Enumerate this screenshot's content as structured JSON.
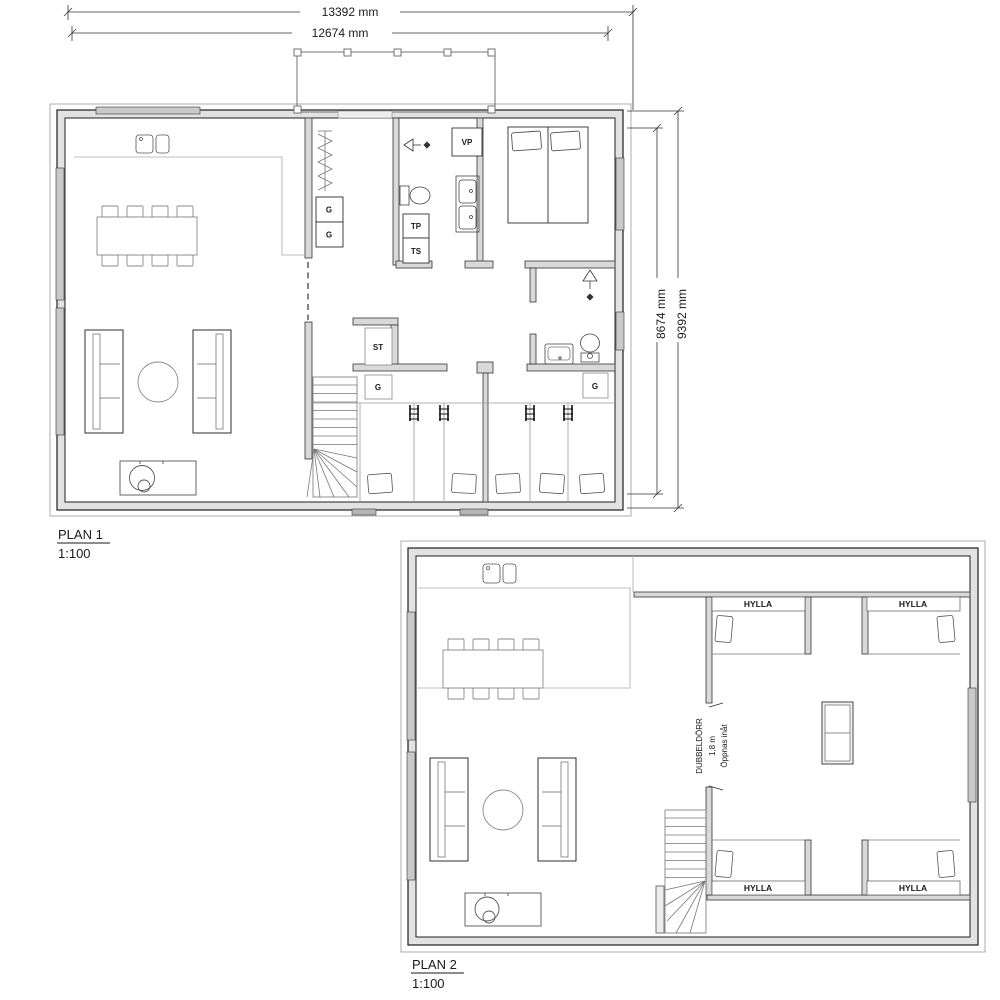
{
  "sheet": {
    "plan1": {
      "title": "PLAN 1",
      "scale": "1:100",
      "dims": {
        "top_outer": "13392 mm",
        "top_inner": "12674 mm",
        "right_inner": "8674 mm",
        "right_outer": "9392 mm"
      },
      "labels": {
        "wardrobe": "G",
        "cleaning_closet": "ST",
        "heat_pump": "VP",
        "laundry_top": "TP",
        "laundry_bottom": "TS"
      }
    },
    "plan2": {
      "title": "PLAN 2",
      "scale": "1:100",
      "labels": {
        "shelf": "HYLLA",
        "door_note_1": "DUBBELDÖRR",
        "door_note_2": "1,8 m",
        "door_note_3": "Öppnas inåt"
      }
    },
    "colors": {
      "line_dark": "#1f1f1f",
      "line_mid": "#6f6f6f",
      "wall_fill": "#e2e2e2",
      "paper": "#ffffff"
    }
  }
}
